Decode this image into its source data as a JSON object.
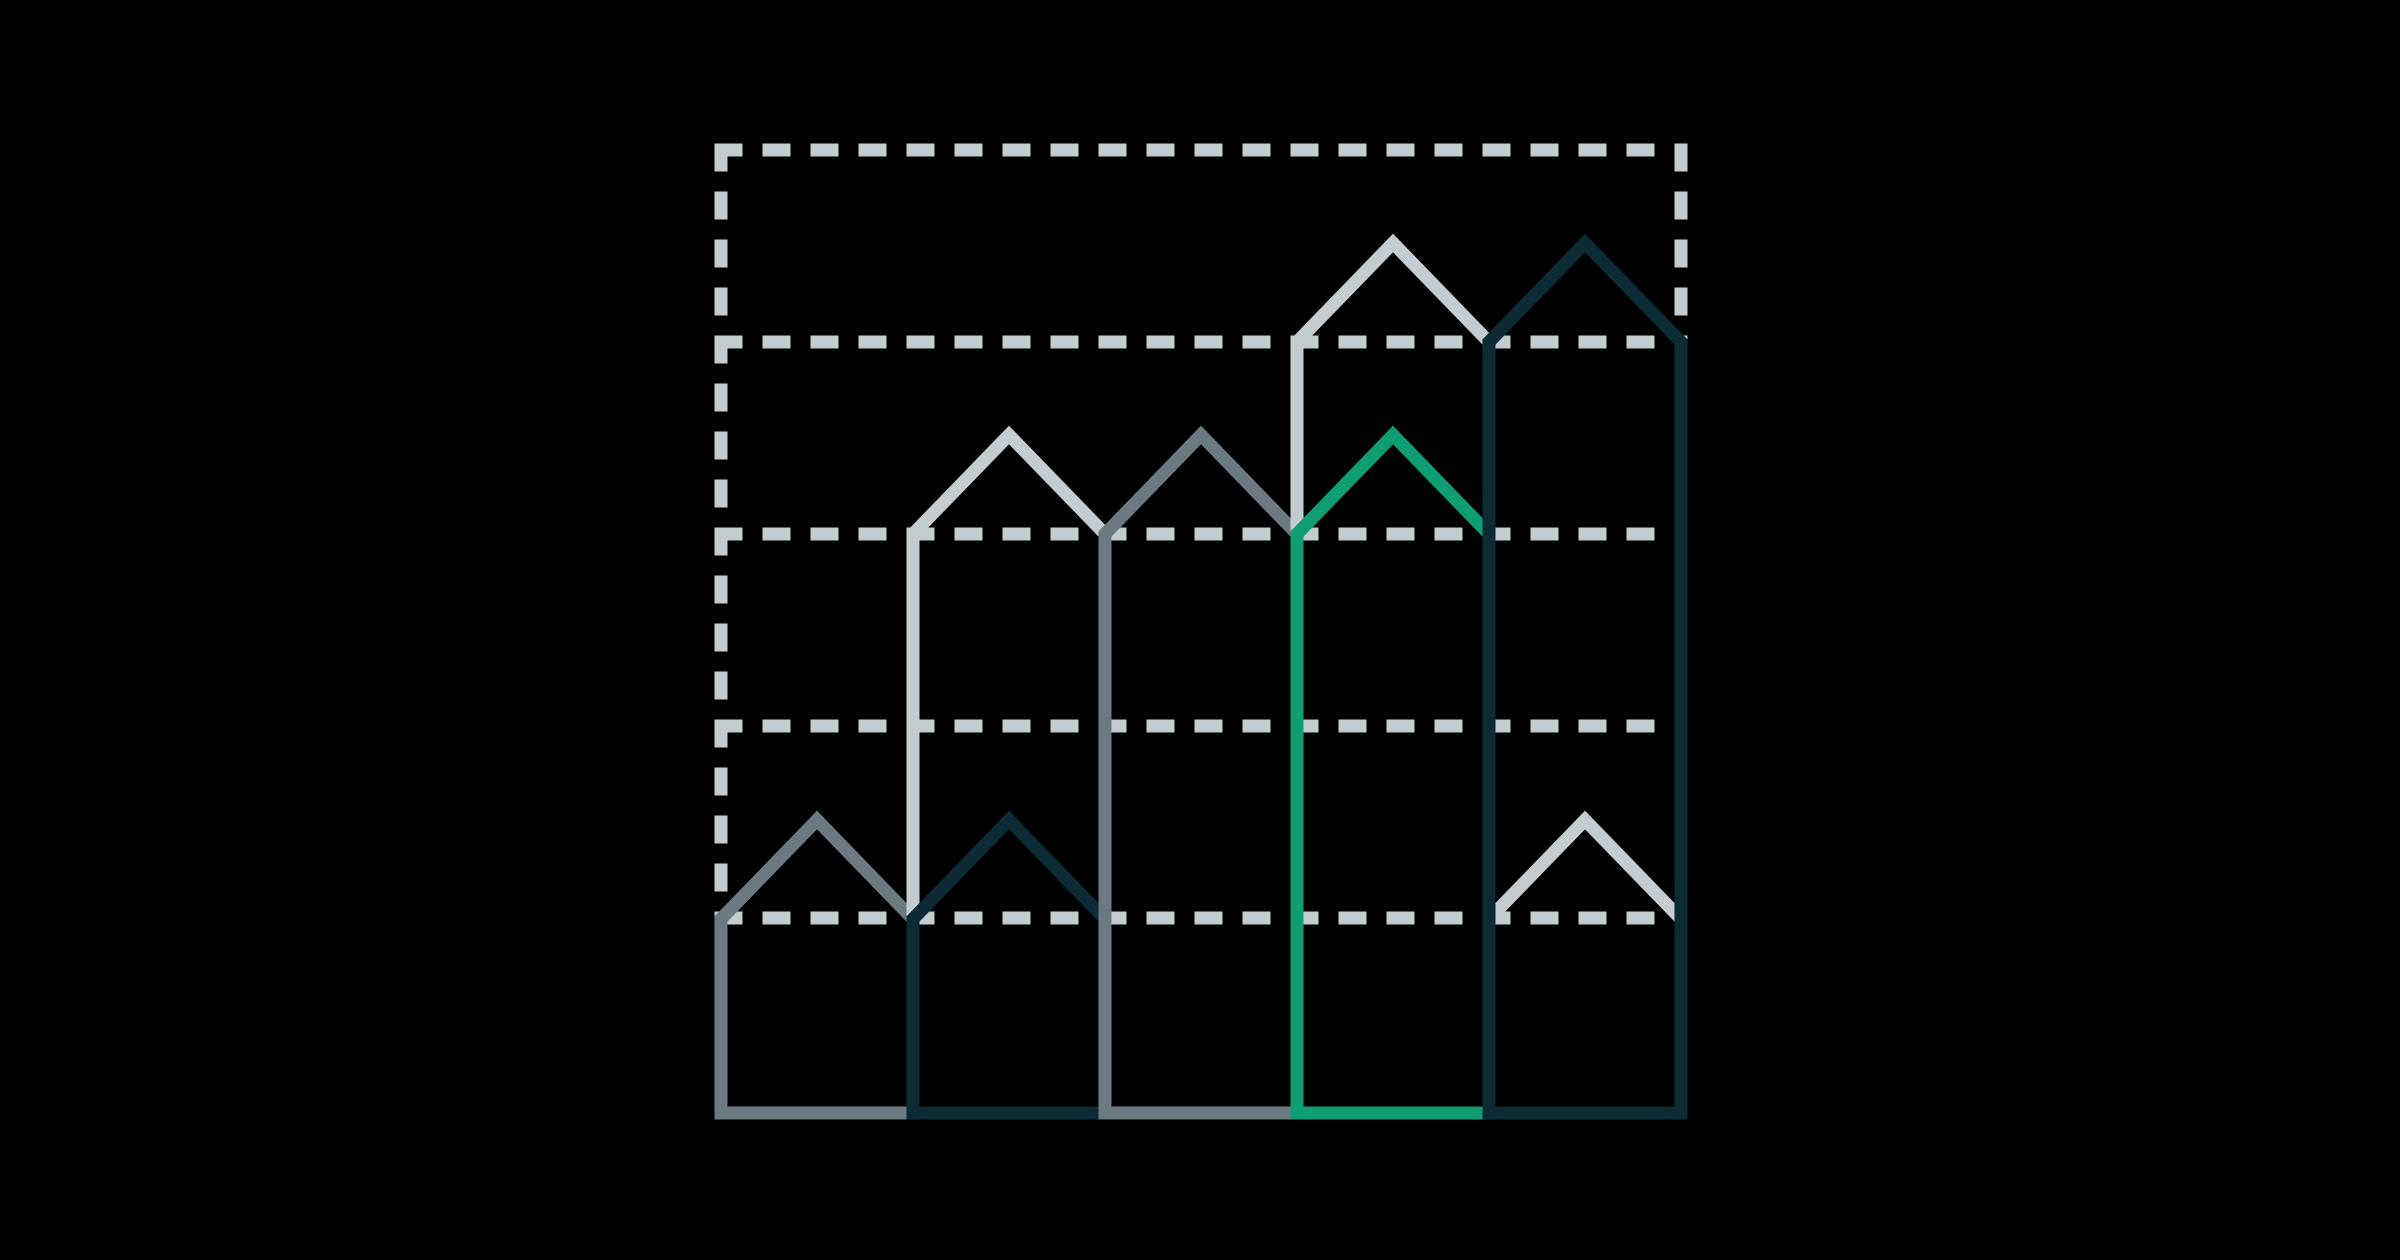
{
  "palette": {
    "background": "#000000",
    "light": "#c3cdd1",
    "gray": "#6b7a80",
    "dark": "#0c2b34",
    "green": "#0f9e73"
  },
  "geometry": {
    "canvas": [
      2400,
      1260
    ],
    "baseline_y": 1113,
    "stroke_width": 13,
    "dash": [
      28,
      20
    ],
    "grid": {
      "color": "light",
      "x0": 721,
      "x1": 1681,
      "y_top": 150,
      "inner_y": [
        342,
        534,
        726,
        918
      ]
    }
  },
  "houses": [
    {
      "id": "small-gray-col1",
      "color": "gray",
      "kind": "pentagon",
      "x": [
        721,
        913
      ],
      "shoulder_y": 919,
      "peak": [
        817,
        820
      ]
    },
    {
      "id": "tall-light-col2",
      "color": "light",
      "kind": "pentagon",
      "x": [
        913,
        1105
      ],
      "shoulder_y": 534,
      "peak": [
        1009,
        435
      ]
    },
    {
      "id": "small-dark-col2",
      "color": "dark",
      "kind": "pentagon",
      "x": [
        913,
        1105
      ],
      "shoulder_y": 919,
      "peak": [
        1009,
        820
      ]
    },
    {
      "id": "tall-gray-col3",
      "color": "gray",
      "kind": "pentagon",
      "x": [
        1105,
        1297
      ],
      "shoulder_y": 534,
      "peak": [
        1201,
        435
      ]
    },
    {
      "id": "tall-light-col4",
      "color": "light",
      "kind": "pentagon",
      "x": [
        1297,
        1489
      ],
      "shoulder_y": 342,
      "peak": [
        1393,
        243
      ]
    },
    {
      "id": "green-tall-col4",
      "color": "green",
      "kind": "pentagon",
      "x": [
        1297,
        1489
      ],
      "shoulder_y": 534,
      "peak": [
        1393,
        435
      ]
    },
    {
      "id": "small-light-roof-col5",
      "color": "light",
      "kind": "roof",
      "x": [
        1489,
        1681
      ],
      "shoulder_y": 919,
      "peak": [
        1585,
        820
      ]
    },
    {
      "id": "tall-dark-col5",
      "color": "dark",
      "kind": "pentagon",
      "x": [
        1489,
        1681
      ],
      "shoulder_y": 342,
      "peak": [
        1585,
        243
      ]
    }
  ],
  "chart_data": {
    "type": "bar",
    "title": "",
    "xlabel": "",
    "ylabel": "",
    "categories": [
      "col-1",
      "col-2",
      "col-3",
      "col-4",
      "col-5"
    ],
    "series": [
      {
        "name": "outer-house-wall-height-units",
        "values": [
          1,
          3,
          3,
          4,
          4
        ]
      },
      {
        "name": "inner-house-wall-height-units",
        "values": [
          null,
          1,
          null,
          3,
          1
        ]
      }
    ],
    "roof_extra_units": 0.5,
    "gridline_unit": 1,
    "ylim": [
      0,
      5
    ],
    "grid": "dashed-horizontal",
    "legend_position": "none",
    "notes": "Abstract house-shaped outline bars on black background; heights measured in dashed-gridline units above the solid baseline."
  }
}
